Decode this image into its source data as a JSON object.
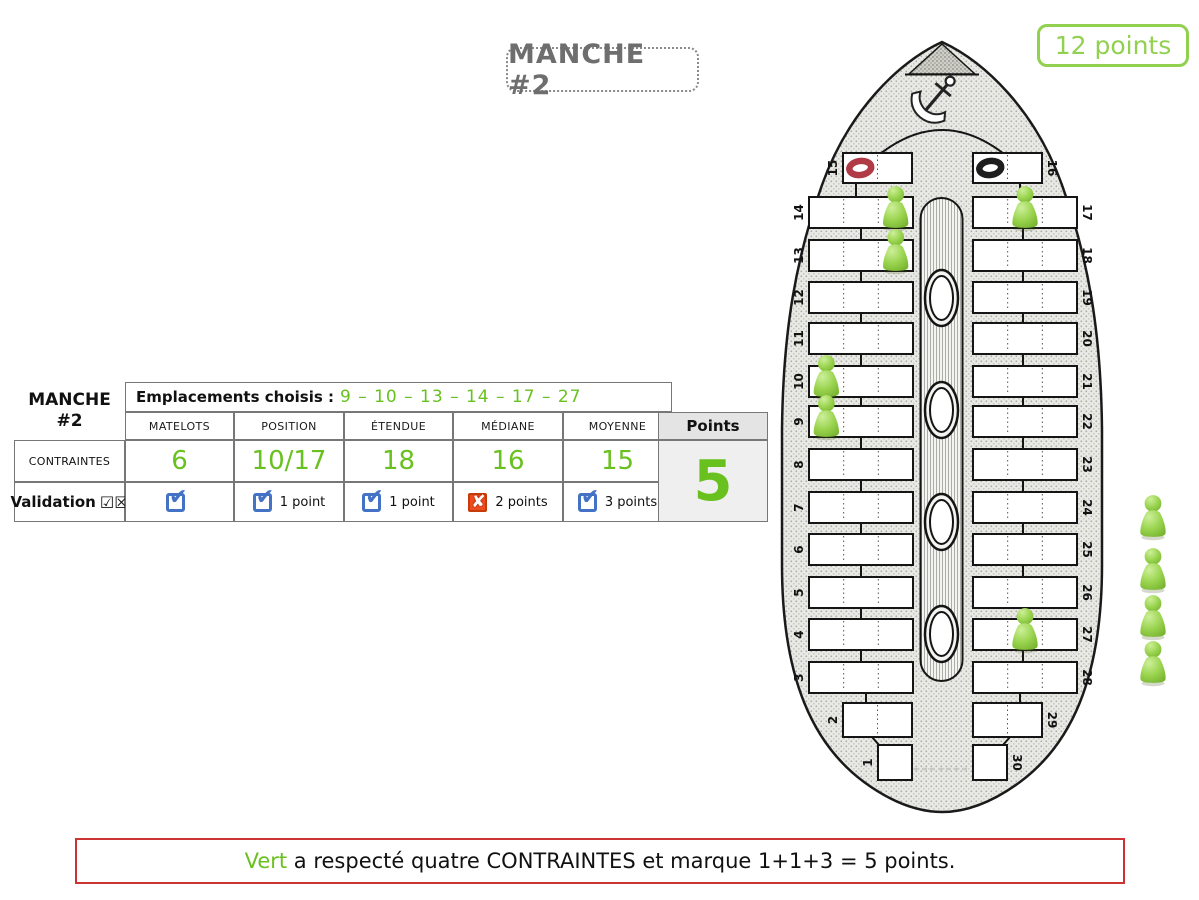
{
  "round_title": "MANCHE #2",
  "total_points_badge": "12 points",
  "table": {
    "round_label_line1": "MANCHE",
    "round_label_line2": "#2",
    "emplacements_label": "Emplacements choisis :",
    "emplacements_values": "9 – 10 – 13 – 14 – 17 – 27",
    "columns": [
      "MATELOTS",
      "POSITION",
      "ÉTENDUE",
      "MÉDIANE",
      "MOYENNE"
    ],
    "points_header": "Points",
    "contraintes_label": "CONTRAINTES",
    "validation_label": "Validation",
    "validation_glyphs": "☑☒",
    "contraintes_values": [
      "6",
      "10/17",
      "18",
      "16",
      "15"
    ],
    "validation": [
      {
        "check": true,
        "label": ""
      },
      {
        "check": true,
        "label": "1 point"
      },
      {
        "check": true,
        "label": "1 point"
      },
      {
        "check": false,
        "label": "2 points"
      },
      {
        "check": true,
        "label": "3 points"
      }
    ],
    "points_value": "5"
  },
  "board": {
    "left_slots": [
      15,
      14,
      13,
      12,
      11,
      10,
      9,
      8,
      7,
      6,
      5,
      4,
      3,
      2,
      1
    ],
    "right_slots": [
      16,
      17,
      18,
      19,
      20,
      21,
      22,
      23,
      24,
      25,
      26,
      27,
      28,
      29,
      30
    ],
    "rings": [
      {
        "slot": 15,
        "cell": 1,
        "name": "red-ring",
        "color": "#b03a45"
      },
      {
        "slot": 16,
        "cell": 1,
        "name": "black-ring",
        "color": "#1d1d1d"
      }
    ],
    "pawns": [
      {
        "slot": 14,
        "cell": 3
      },
      {
        "slot": 13,
        "cell": 3
      },
      {
        "slot": 17,
        "cell": 2
      },
      {
        "slot": 10,
        "cell": 1
      },
      {
        "slot": 9,
        "cell": 1
      },
      {
        "slot": 27,
        "cell": 2
      }
    ],
    "spare_pawns": 4,
    "pawn_color": "#8dc63f"
  },
  "banner": {
    "player": "Vert",
    "text_after": " a respecté quatre CONTRAINTES et marque 1+1+3 = 5 points."
  },
  "colors": {
    "green": "#69c120",
    "badge_green": "#92d050",
    "check_blue": "#4472c4",
    "cross_orange": "#ee4d21",
    "banner_border": "#cc3333"
  }
}
